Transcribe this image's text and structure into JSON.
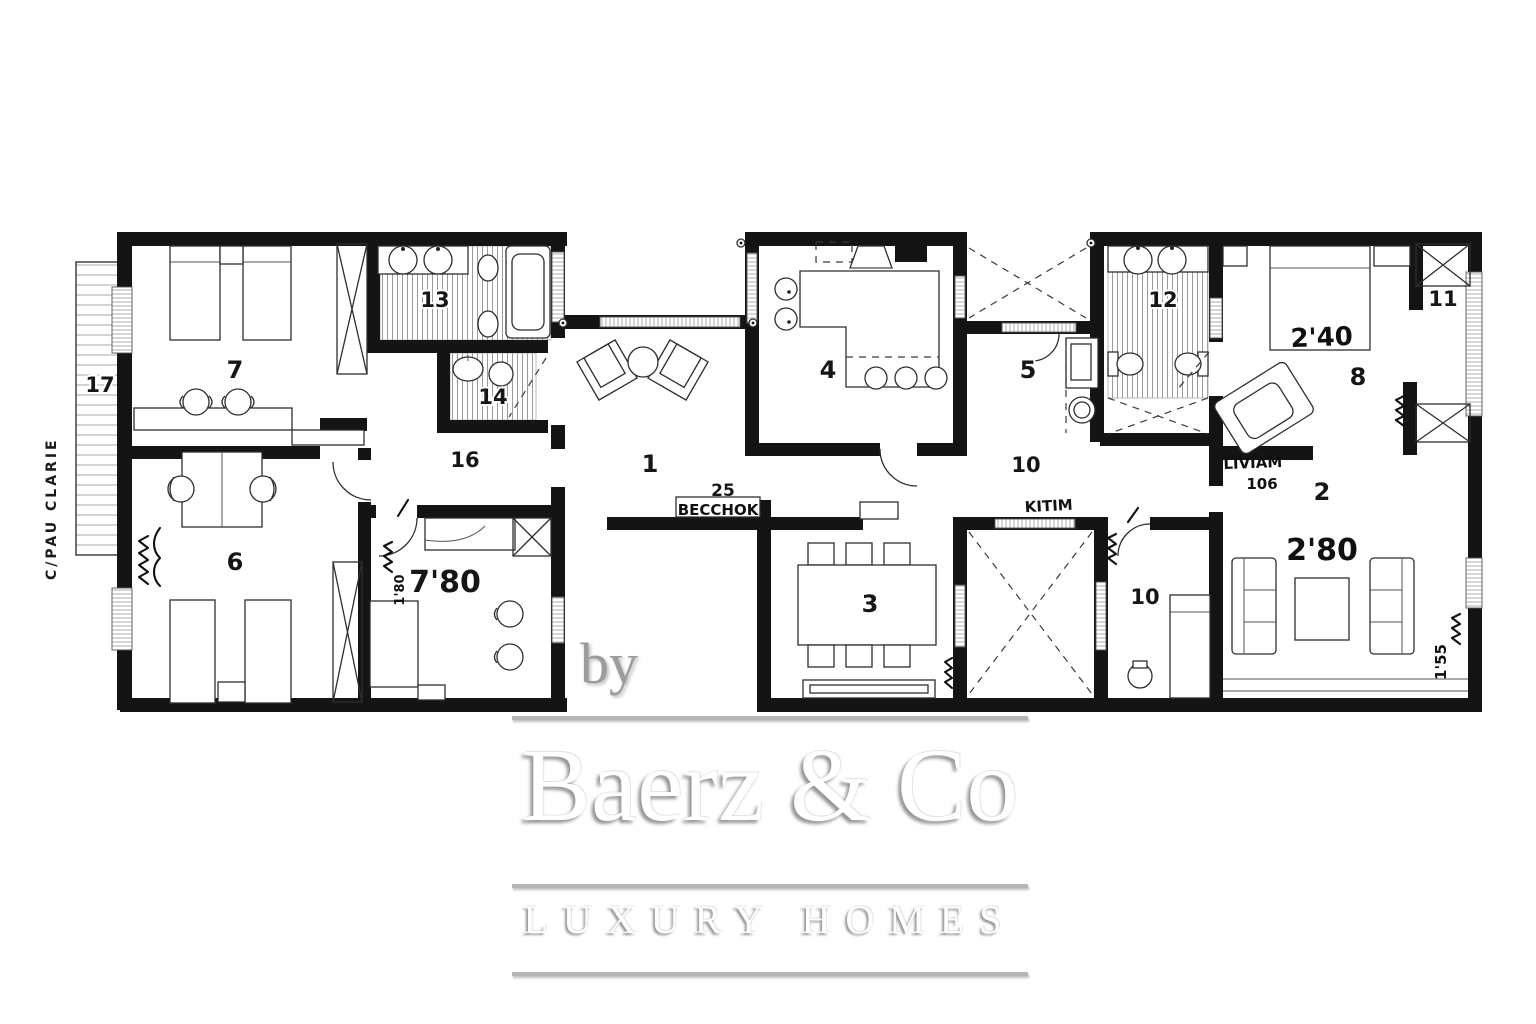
{
  "street_label": "C/PAU CLARIE",
  "rooms": [
    {
      "name": "entry-hall",
      "label": "1"
    },
    {
      "name": "living-room",
      "label": "2"
    },
    {
      "name": "dining-room",
      "label": "3"
    },
    {
      "name": "kitchen",
      "label": "4"
    },
    {
      "name": "utility-room",
      "label": "5"
    },
    {
      "name": "bedroom-6",
      "label": "6"
    },
    {
      "name": "bedroom-7",
      "label": "7"
    },
    {
      "name": "bedroom-8",
      "label": "8"
    },
    {
      "name": "corridor-upper",
      "label": "10"
    },
    {
      "name": "corridor-lower",
      "label": "10"
    },
    {
      "name": "closet-11",
      "label": "11"
    },
    {
      "name": "bathroom-12",
      "label": "12"
    },
    {
      "name": "bathroom-13",
      "label": "13"
    },
    {
      "name": "bathroom-14",
      "label": "14"
    },
    {
      "name": "hall-16",
      "label": "16"
    },
    {
      "name": "terrace-17",
      "label": "17"
    },
    {
      "name": "sideboard-25",
      "label": "25"
    }
  ],
  "annotations": [
    {
      "name": "becchok",
      "text": "BECCHOK"
    },
    {
      "name": "kitim",
      "text": "KITIM"
    },
    {
      "name": "liviam",
      "text": "LIVIAM"
    },
    {
      "name": "liviam-number",
      "text": "106"
    },
    {
      "name": "bed-width",
      "text": "2'40"
    },
    {
      "name": "sofa-width",
      "text": "2'80"
    },
    {
      "name": "room-width",
      "text": "7'80"
    },
    {
      "name": "window-width",
      "text": "1'55"
    },
    {
      "name": "door-width",
      "text": "1'80"
    }
  ],
  "watermark": {
    "by": "by",
    "brand": "Baerz & Co",
    "tagline": "LUXURY HOMES"
  }
}
